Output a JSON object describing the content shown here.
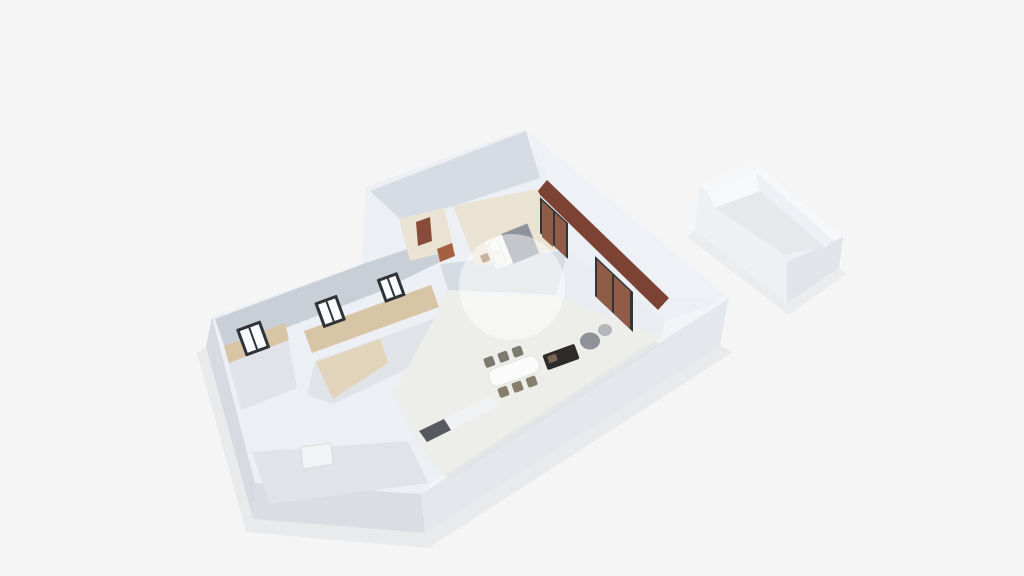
{
  "scene": {
    "label": "3D isometric floor plan rendering",
    "watermark_opacity": "0.48"
  },
  "colors": {
    "background": "#f5f5f6",
    "shadow": "#d3d6db",
    "wall_base": "#eceff3",
    "wall_top": "#f2f4f7",
    "ext_right": "#e4e7ec",
    "ext_left": "#dadee4",
    "ext_end": "#d7dbe1",
    "int_face": "#c9cfd7",
    "int_face_light": "#d6dce3",
    "balcony_wall": "#eef1f5",
    "living_back_wall": "#e9edf2",
    "floor_gray": "#e0e3e7",
    "floor_wood": "#d7c5a6",
    "floor_wood_light": "#e2d4ba",
    "floor_cream": "#eae2d2",
    "floor_living": "#edeeea",
    "balcony_wood": "#7c4335",
    "window_frame": "#2f3338",
    "window_pane": "#fafbfc",
    "door_brown": "#8a4c3a",
    "desk_brown": "#a55f41",
    "bed_white": "#f5f5f3",
    "bed_blanket": "#8d939b",
    "nightstand_brown": "#9a6a4e",
    "slider_frame": "#31353a",
    "slider_panel": "#8f5c47",
    "table_white": "#fafbfa",
    "chair_tan": "#877e6e",
    "chair_gray": "#7d7a70",
    "sofa_dark": "#2d2c2a",
    "sofa_cushion": "#7a6450",
    "pouf_dark": "#8f9399",
    "pouf_light": "#b3b6bb",
    "counter_white": "#f0f2f3",
    "counter_dark": "#565a5f",
    "door_white": "#f2f3f5",
    "floor_ao": "#dfe2e6",
    "watermark": "#ffffff",
    "box_base": "#edeff3",
    "box_left": "#eef1f4",
    "box_right": "#e1e5ea",
    "box_inner_bright": "#f6f8fa",
    "box_inner_mid": "#edf0f4",
    "box_floor": "#e6e8eb",
    "box_rim": "#f5f7f9"
  }
}
